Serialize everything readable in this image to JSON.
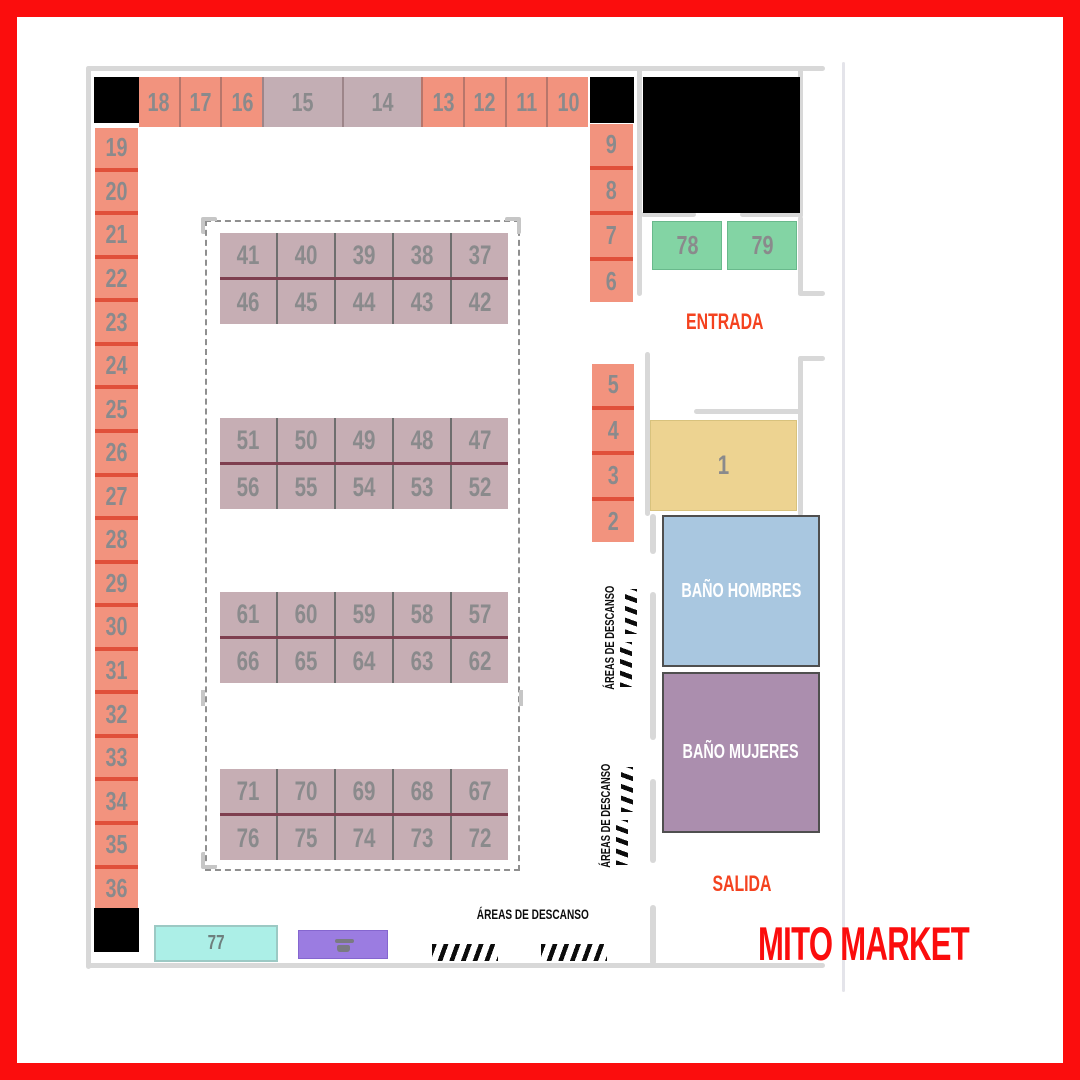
{
  "title": "MITO MARKET",
  "labels": {
    "entrada": "ENTRADA",
    "salida": "SALIDA",
    "bano_hombres": "BAÑO HOMBRES",
    "bano_mujeres": "BAÑO MUJERES",
    "areas_descanso": "ÁREAS DE DESCANSO"
  },
  "stalls": {
    "top_row": [
      "18",
      "17",
      "16",
      "15",
      "14",
      "13",
      "12",
      "11",
      "10"
    ],
    "left_column": [
      "19",
      "20",
      "21",
      "22",
      "23",
      "24",
      "25",
      "26",
      "27",
      "28",
      "29",
      "30",
      "31",
      "32",
      "33",
      "34",
      "35",
      "36"
    ],
    "right_column_upper": [
      "9",
      "8",
      "7",
      "6"
    ],
    "right_column_lower": [
      "5",
      "4",
      "3",
      "2"
    ],
    "entrance_green": [
      "78",
      "79"
    ],
    "stall_one": "1",
    "stall_77": "77",
    "center_blocks": [
      {
        "rows": [
          [
            "41",
            "40",
            "39",
            "38",
            "37"
          ],
          [
            "46",
            "45",
            "44",
            "43",
            "42"
          ]
        ]
      },
      {
        "rows": [
          [
            "51",
            "50",
            "49",
            "48",
            "47"
          ],
          [
            "56",
            "55",
            "54",
            "53",
            "52"
          ]
        ]
      },
      {
        "rows": [
          [
            "61",
            "60",
            "59",
            "58",
            "57"
          ],
          [
            "66",
            "65",
            "64",
            "63",
            "62"
          ]
        ]
      },
      {
        "rows": [
          [
            "71",
            "70",
            "69",
            "68",
            "67"
          ],
          [
            "76",
            "75",
            "74",
            "73",
            "72"
          ]
        ]
      }
    ]
  },
  "colors": {
    "frame_red": "#FB0D0D",
    "title_red": "#FB0D0D",
    "accent_orange": "#F4421F",
    "stall_salmon": "#F2937E",
    "salmon_divider": "#E0503A",
    "stall_mauve": "#C6AEB4",
    "mauve_row_divider": "#7E3F4F",
    "stall_green": "#83D4A4",
    "stall_yellow": "#EDD391",
    "bath_blue": "#A9C7E0",
    "bath_purple": "#AB8EAE",
    "stall_cyan": "#ACEFE7",
    "stall_violet": "#9B7CE1",
    "number_gray": "#8A8A8C",
    "wall_gray": "#D8D8D8",
    "black_area": "#000000"
  }
}
